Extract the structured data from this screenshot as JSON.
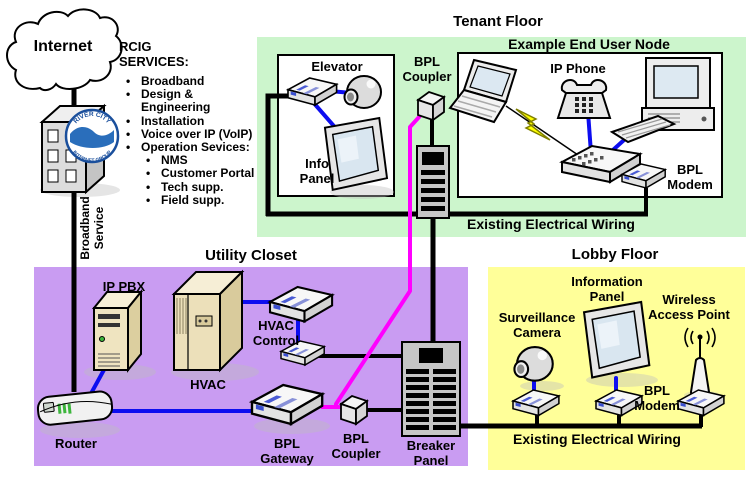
{
  "colors": {
    "tenant_bg": "#ccf5cc",
    "utility_bg": "#c99cf2",
    "lobby_bg": "#ffff99",
    "line_black": "#000000",
    "line_blue": "#0d0df0",
    "line_magenta": "#ff00ff",
    "wireless_bolt": "#ffff00"
  },
  "internet": {
    "label": "Internet"
  },
  "provider": {
    "heading_lines": [
      "RCIG",
      "SERVICES:"
    ],
    "service_lines": [
      {
        "text": "Broadband"
      },
      {
        "text": "Design &"
      },
      {
        "text": "Engineering"
      },
      {
        "text": "Installation"
      },
      {
        "text": "Voice over IP (VoIP)"
      },
      {
        "text": "Operation Sevices:"
      },
      {
        "text": "NMS"
      },
      {
        "text": "Customer Portal"
      },
      {
        "text": "Tech supp."
      },
      {
        "text": "Field supp."
      }
    ],
    "logo_arc_top": "RIVER CITY",
    "logo_arc_bottom": "INTERNET GROUP",
    "broadband_lines": [
      "Broadband",
      "Service"
    ]
  },
  "tenant": {
    "title": "Tenant Floor",
    "elevator_label": "Elevator",
    "info_panel_lines": [
      "Info",
      "Panel"
    ],
    "coupler_lines": [
      "BPL",
      "Coupler"
    ],
    "node_title": "Example End User Node",
    "ip_phone_label": "IP Phone",
    "modem_lines": [
      "BPL",
      "Modem"
    ],
    "wiring_label": "Existing Electrical Wiring"
  },
  "utility": {
    "title": "Utility Closet",
    "ip_pbx_label": "IP PBX",
    "hvac_label": "HVAC",
    "hvac_control_lines": [
      "HVAC",
      "Control"
    ],
    "router_label": "Router",
    "gateway_lines": [
      "BPL",
      "Gateway"
    ],
    "coupler_lines": [
      "BPL",
      "Coupler"
    ],
    "breaker_lines": [
      "Breaker",
      "Panel"
    ]
  },
  "lobby": {
    "title": "Lobby Floor",
    "camera_lines": [
      "Surveillance",
      "Camera"
    ],
    "panel_lines": [
      "Information",
      "Panel"
    ],
    "wap_lines": [
      "Wireless",
      "Access Point"
    ],
    "modem_lines": [
      "BPL",
      "Modem"
    ],
    "wiring_label": "Existing Electrical Wiring"
  }
}
